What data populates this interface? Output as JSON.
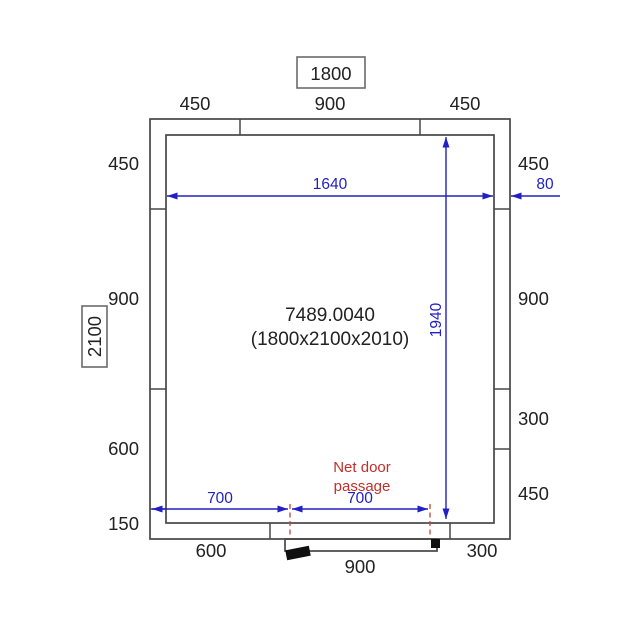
{
  "diagram": {
    "type": "cold-room-floor-plan",
    "colors": {
      "dimension_blue": "#2220c4",
      "annotation_red": "#c0302a",
      "wall_gray": "#474747",
      "label_black": "#222222",
      "background": "#ffffff"
    },
    "overall_width_label": "1800",
    "overall_depth_label": "2100",
    "top_panel_dims": [
      "450",
      "900",
      "450"
    ],
    "left_panel_dims": [
      "450",
      "900",
      "600",
      "150"
    ],
    "right_panel_dims": [
      "450",
      "900",
      "300",
      "450"
    ],
    "bottom_segment_dims": [
      "600",
      "900",
      "300"
    ],
    "interior": {
      "model_code": "7489.0040",
      "overall_dimensions": "(1800x2100x2010)",
      "inner_width_dim": "1640",
      "inner_depth_dim": "1940",
      "wall_thickness_dim": "80"
    },
    "door": {
      "note_line1": "Net door",
      "note_line2": "passage",
      "offset_dim": "700",
      "passage_dim": "700"
    }
  }
}
